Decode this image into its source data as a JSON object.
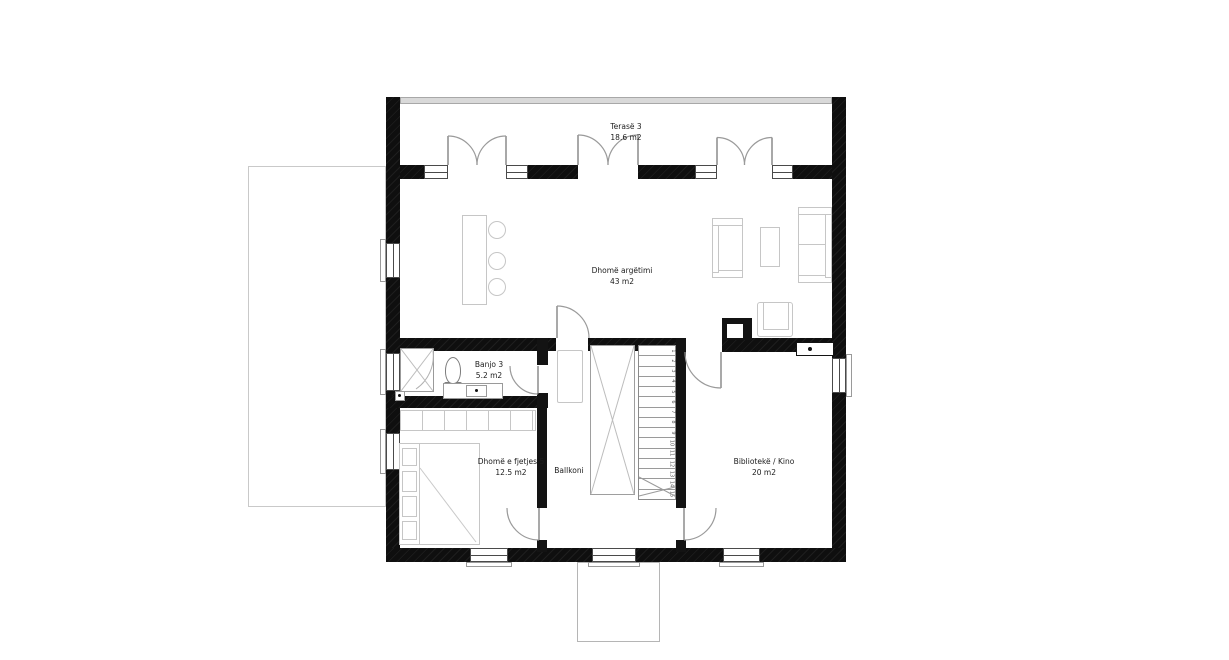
{
  "rooms": {
    "terrace": {
      "name": "Terasë 3",
      "area": "18.6 m2"
    },
    "living": {
      "name": "Dhomë argëtimi",
      "area": "43 m2"
    },
    "bath": {
      "name": "Banjo 3",
      "area": "5.2 m2"
    },
    "bedroom": {
      "name": "Dhomë e fjetjes 5",
      "area": "12.5 m2"
    },
    "balcony": {
      "name": "Ballkoni"
    },
    "library": {
      "name": "Bibliotekë / Kino",
      "area": "20 m2"
    }
  },
  "stairs": {
    "numbers": [
      "1",
      "2",
      "3",
      "4",
      "5",
      "6",
      "7",
      "8",
      "9",
      "10",
      "11",
      "12",
      "13",
      "14",
      "15"
    ]
  },
  "colors": {
    "wall": "#131313",
    "furniture_outline": "#c6c6c6",
    "window_frame": "#4a4a4a"
  }
}
